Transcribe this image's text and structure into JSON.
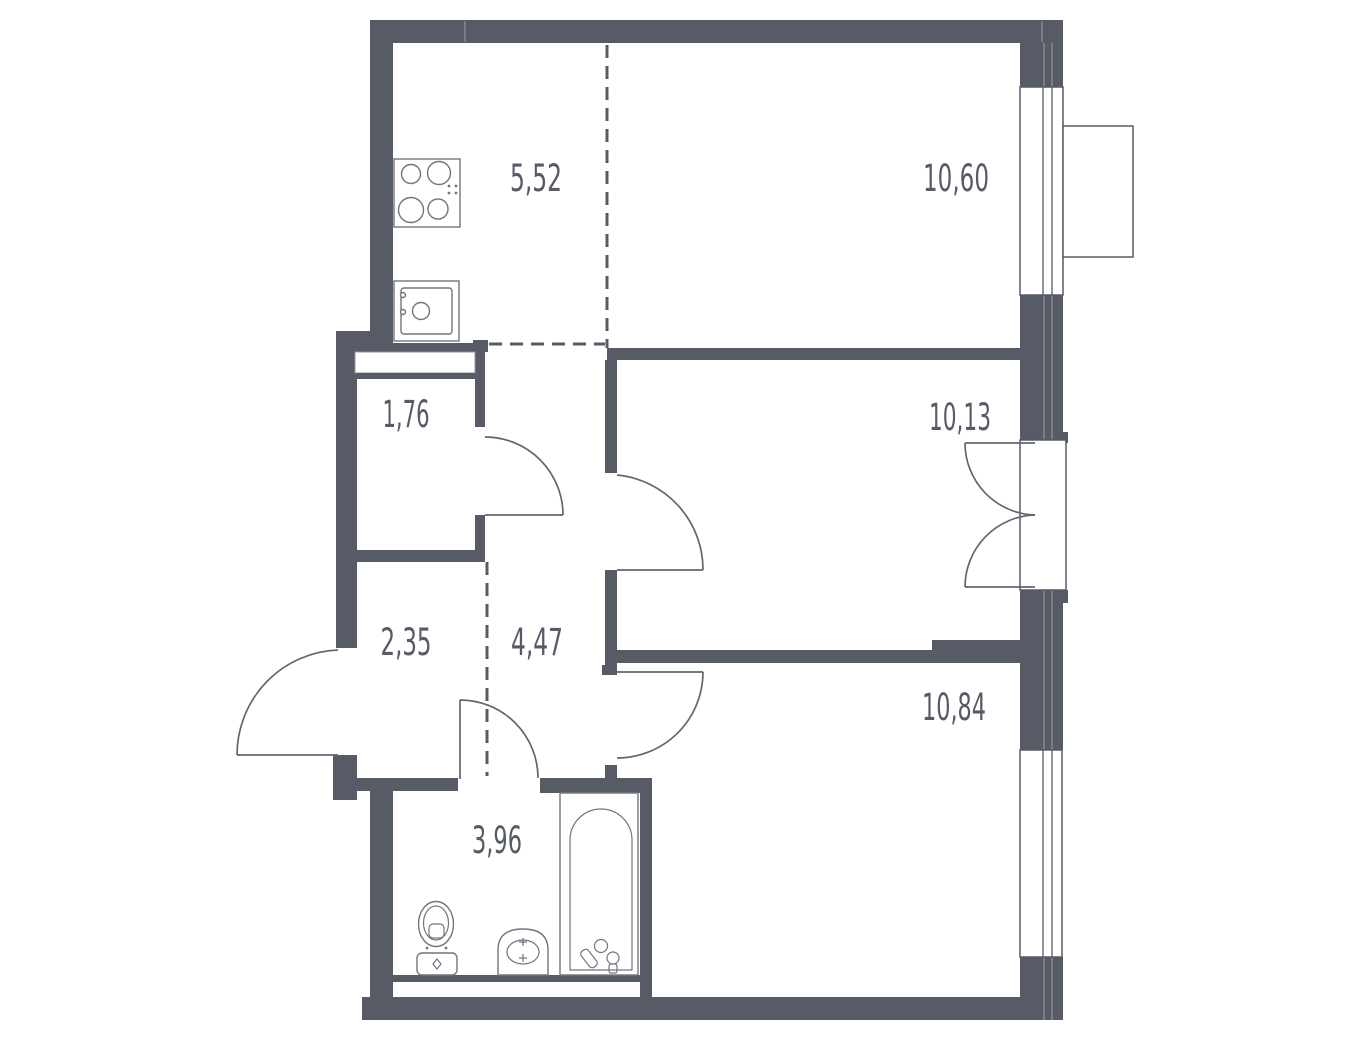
{
  "plan": {
    "title": "2-room apartment floor plan",
    "colors": {
      "wall": "#575b66",
      "line": "#71757e",
      "text": "#575b66",
      "background": "#ffffff"
    },
    "rooms": [
      {
        "name": "kitchen",
        "area": "5,52"
      },
      {
        "name": "living-room",
        "area": "10,60"
      },
      {
        "name": "storage",
        "area": "1,76"
      },
      {
        "name": "bedroom",
        "area": "10,13"
      },
      {
        "name": "entry-hall",
        "area": "2,35"
      },
      {
        "name": "corridor",
        "area": "4,47"
      },
      {
        "name": "bedroom-2",
        "area": "10,84"
      },
      {
        "name": "bathroom",
        "area": "3,96"
      }
    ],
    "fixtures": [
      "stove",
      "kitchen-sink",
      "toilet",
      "washbasin",
      "bathtub",
      "entrance-door",
      "balcony-door",
      "window",
      "balcony-basket"
    ]
  }
}
